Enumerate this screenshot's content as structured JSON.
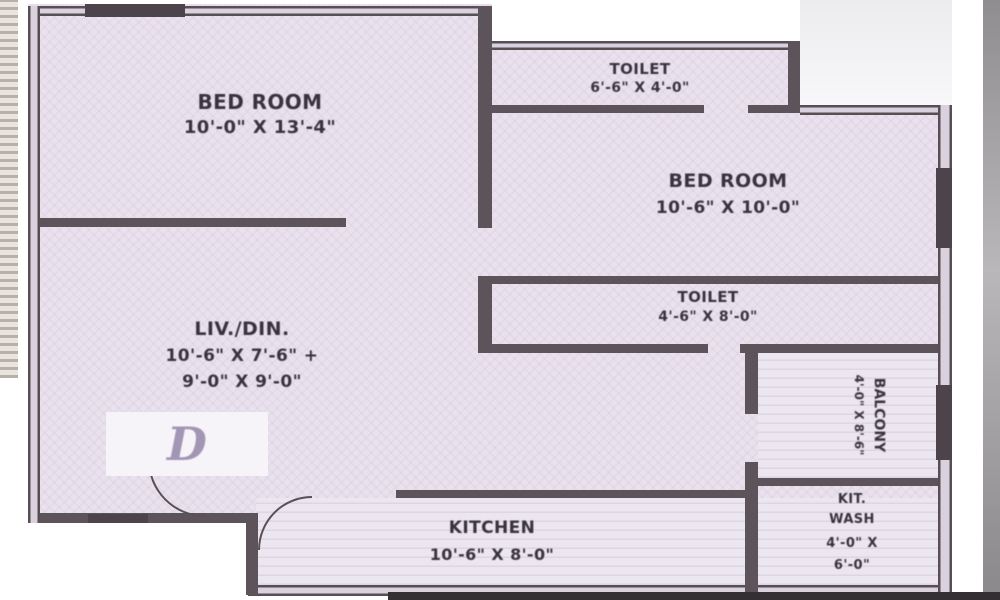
{
  "plan": {
    "unit_label": "D",
    "rooms": {
      "bedroom1": {
        "name": "BED ROOM",
        "dims": "10'-0\" X 13'-4\""
      },
      "toilet1": {
        "name": "TOILET",
        "dims": "6'-6\" X 4'-0\""
      },
      "bedroom2": {
        "name": "BED ROOM",
        "dims": "10'-6\" X 10'-0\""
      },
      "toilet2": {
        "name": "TOILET",
        "dims": "4'-6\" X 8'-0\""
      },
      "living": {
        "name": "LIV./DIN.",
        "dims_line1": "10'-6\" X 7'-6\" +",
        "dims_line2": "9'-0\" X 9'-0\""
      },
      "kitchen": {
        "name": "KITCHEN",
        "dims": "10'-6\" X 8'-0\""
      },
      "balcony": {
        "name": "BALCONY",
        "dims": "4'-0\" X 8'-6\""
      },
      "kit_wash": {
        "line1": "KIT.",
        "line2": "WASH",
        "line3": "4'-0\" X",
        "line4": "6'-0\""
      }
    },
    "colors": {
      "room_fill": "#e9e2ee",
      "wall": "#584e54",
      "text": "#39323f",
      "unit_letter": "#a396b4"
    }
  }
}
